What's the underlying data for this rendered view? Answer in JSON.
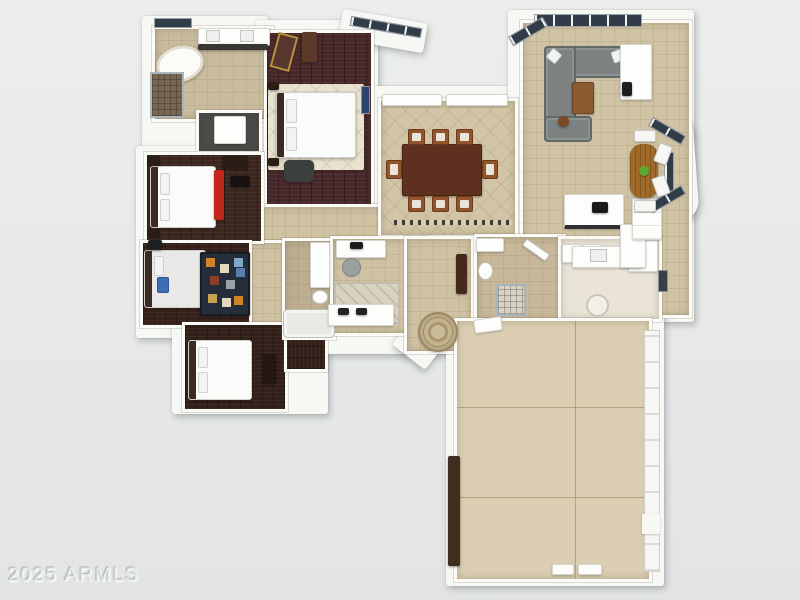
{
  "watermark": {
    "text": "2025 ARMLS"
  },
  "scene": {
    "description": "3D rendered top-down residential floor plan on gray backdrop",
    "background_color": "#e8eaea",
    "wall_color": "#f7f7f3"
  },
  "palette": {
    "tile_beige": "#d0c3a4",
    "rug_cream": "#e9e2cf",
    "sofa_gray": "#7b8281",
    "dining_wood": "#5d3020",
    "chair_wood": "#92542a",
    "coffee_table_wood": "#8a5a30",
    "accent_red": "#c1271d",
    "window_glass": "#303c48",
    "plant_green": "#5ea832",
    "nook_table_wood": "#a06a28",
    "dark_furniture": "#2a1d16",
    "shower_stone": "#776751",
    "gold_frame": "#b8913c"
  },
  "rooms": {
    "master_bathroom": {
      "floor_color": "#c9bc9e"
    },
    "walk_in_closet": {
      "floor_color": "#4b4b49"
    },
    "master_bedroom": {
      "floor_color": "#49282b"
    },
    "bedroom_2": {
      "floor_color": "#3d2820"
    },
    "bedroom_3": {
      "floor_color": "#37221b"
    },
    "bedroom_4": {
      "floor_color": "#33201a"
    },
    "hall_bathroom": {
      "floor_color": "#bdae91"
    },
    "office": {
      "floor_color": "#cfc2a3"
    },
    "foyer": {
      "floor_color": "#cfc2a3"
    },
    "guest_bathroom": {
      "floor_color": "#c6b899"
    },
    "laundry_room": {
      "floor_color": "#e9e4d7"
    },
    "dining_room": {
      "floor_color": "#d2c5a6"
    },
    "great_room": {
      "floor_color": "#d0c3a4"
    },
    "hallway": {
      "floor_color": "#cfc2a3"
    },
    "garage": {
      "floor_color": "#dbceb2"
    }
  }
}
